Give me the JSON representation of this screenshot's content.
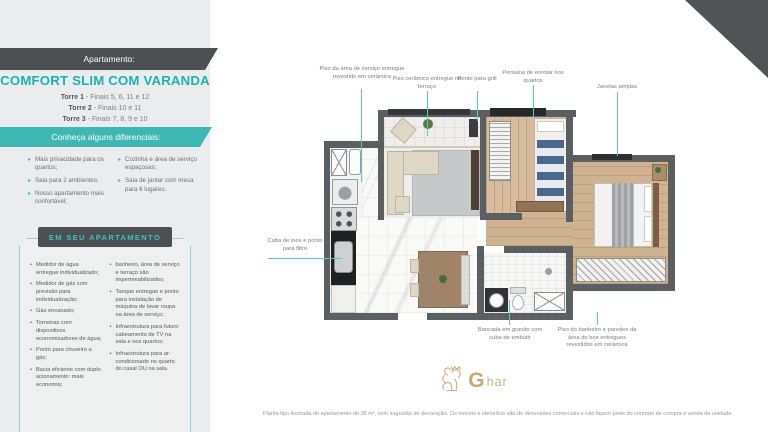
{
  "sidebar": {
    "banner_label": "Apartamento:",
    "title": "COMFORT SLIM COM VARANDA",
    "towers": [
      {
        "name": "Torre 1",
        "info": " - Finais 5, 6, 11 e 12"
      },
      {
        "name": "Torre 2",
        "info": " - Finais 10 e 11"
      },
      {
        "name": "Torre 3",
        "info": " - Finais 7, 8, 9 e 10"
      }
    ],
    "differentials_banner": "Conheça alguns diferenciais:",
    "differentials_left": [
      "Mais privacidade para os quartos;",
      "Sala para 2 ambientes;",
      "Nosso apartamento mais confortável;"
    ],
    "differentials_right": [
      "Cozinha e área de serviço espaçosas;",
      "Sala de jantar com mesa para 6 lugares."
    ],
    "apartment_box_title": "EM SEU APARTAMENTO",
    "features_left": [
      "Medidor de água entregue individualizado;",
      "Medidor de gás com previsão para individualização;",
      "Gás encanado;",
      "Torneiras com dispositivos economizadores de água;",
      "Ponto para chuveiro a gás;",
      "Bacia eficiente com duplo acionamento: mais economia;"
    ],
    "features_right": [
      "banheiro, área de serviço e terraço são impermeabilizados;",
      "Tanque entregue e ponto para instalação de máquina de lavar roupa na área de serviço;",
      "Infraestrutura para futuro cabeamento de TV na sala e nos quartos;",
      "Infraestrutura para ar-condicionado no quarto do casal OU na sala."
    ]
  },
  "plan": {
    "callouts": {
      "service_floor": "Piso da área de serviço entregue revestido em cerâmica",
      "terrace_floor": "Piso cerâmico entregue no terraço",
      "grill": "Ponto para grill",
      "blinds": "Persiana de enrolar nos quartos",
      "windows": "Janelas amplas",
      "inox_sink": "Cuba de inox e ponto para filtro",
      "granite_counter": "Bancada em granito com cuba de embutir",
      "bath_floor": "Piso do banheiro e paredes da área do box entregues revestidos em cerâmica"
    }
  },
  "footer": {
    "logo_g": "G",
    "logo_rest": "har",
    "disclaimer": "Planta tipo ilustrada do apartamento de 38 m², com sugestão de decoração. Os móveis e utensílios são de dimensões comerciais e não fazem parte do contrato de compra e venda da unidade."
  },
  "colors": {
    "teal": "#3eb8b4",
    "dark": "#4d5053",
    "gold": "#c8a873"
  }
}
